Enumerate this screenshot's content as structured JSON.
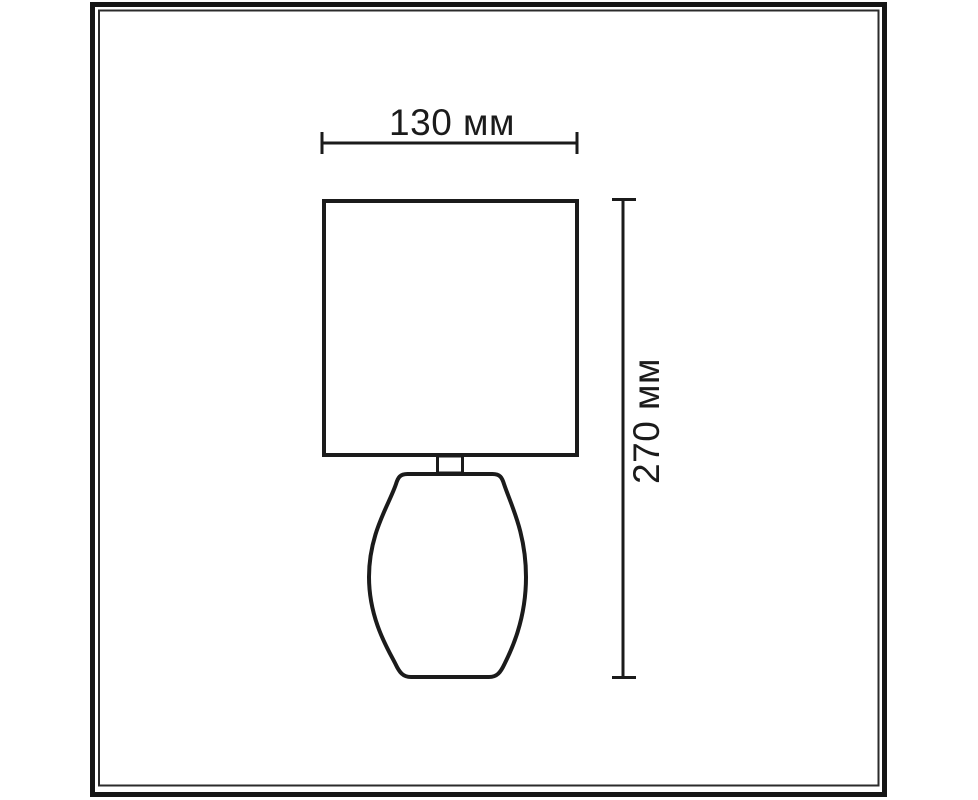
{
  "page": {
    "background": "#ffffff"
  },
  "frame": {
    "outer_color": "#151515",
    "inner_color": "#2b2b2b"
  },
  "drawing": {
    "subject": "table-lamp",
    "ink": "#1b1b1b"
  },
  "dimensions": {
    "width": {
      "label": "130 мм",
      "value": 130,
      "unit": "мм"
    },
    "height": {
      "label": "270 мм",
      "value": 270,
      "unit": "мм"
    }
  }
}
